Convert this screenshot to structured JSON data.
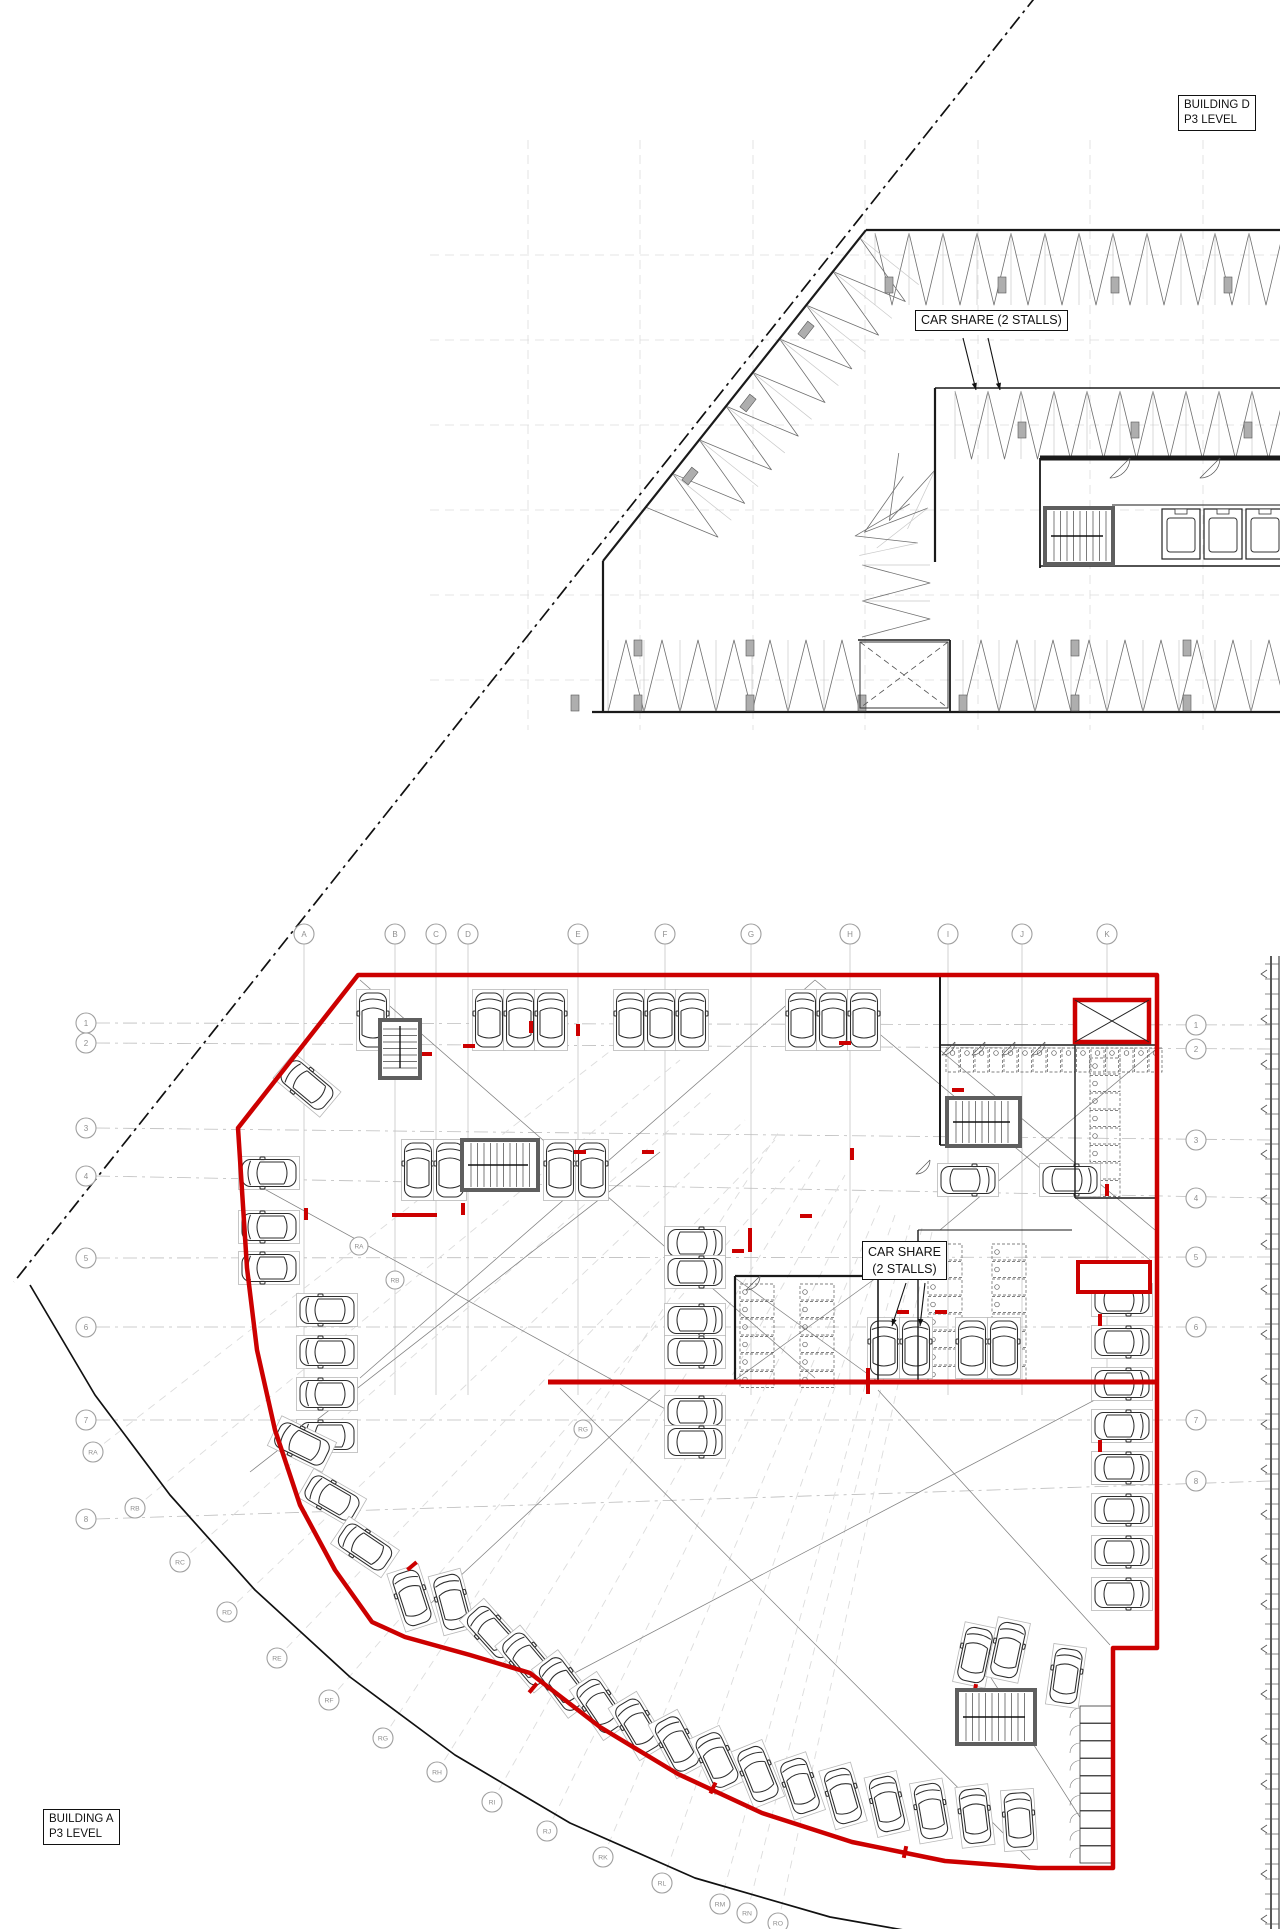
{
  "labels": {
    "building_d": {
      "line1": "BUILDING D",
      "line2": "P3 LEVEL"
    },
    "car_share_top": "CAR SHARE (2 STALLS)",
    "car_share_lower": {
      "line1": "CAR SHARE",
      "line2": "(2 STALLS)"
    },
    "building_a": {
      "line1": "BUILDING A",
      "line2": "P3 LEVEL"
    }
  },
  "colors": {
    "wall_red": "#cc0000",
    "line": "#1c1c1c",
    "core_gray": "#5f5f5f",
    "grid_light": "#dcdcdc",
    "grid_mid": "#bdbdbd",
    "stall_gray": "#b8b8b8",
    "sight": "#808080",
    "column_fill": "#aeaeae",
    "bubble": "#a0a0a0",
    "rack": "#5a5a5a"
  },
  "grid": {
    "letters": [
      {
        "label": "A",
        "x": 304
      },
      {
        "label": "B",
        "x": 395
      },
      {
        "label": "C",
        "x": 436
      },
      {
        "label": "D",
        "x": 468
      },
      {
        "label": "E",
        "x": 578
      },
      {
        "label": "F",
        "x": 665
      },
      {
        "label": "G",
        "x": 751
      },
      {
        "label": "H",
        "x": 850
      },
      {
        "label": "I",
        "x": 948
      },
      {
        "label": "J",
        "x": 1022
      },
      {
        "label": "K",
        "x": 1107
      }
    ],
    "letter_bubble_y": 934,
    "letter_line": [
      944,
      1395
    ],
    "numbers": [
      {
        "label": "1",
        "yl": 1023,
        "yr": 1025
      },
      {
        "label": "2",
        "yl": 1043,
        "yr": 1049
      },
      {
        "label": "3",
        "yl": 1128,
        "yr": 1140
      },
      {
        "label": "4",
        "yl": 1176,
        "yr": 1198
      },
      {
        "label": "5",
        "yl": 1258,
        "yr": 1257
      },
      {
        "label": "6",
        "yl": 1327,
        "yr": 1327
      },
      {
        "label": "7",
        "yl": 1420,
        "yr": 1420
      },
      {
        "label": "8",
        "yl": 1519,
        "yr": 1481
      }
    ],
    "num_x_left": 86,
    "num_x_right": 1196,
    "radial": [
      {
        "label": "RA",
        "x": 93,
        "y": 1452,
        "ix": 640,
        "iy": 1028
      },
      {
        "label": "RB",
        "x": 135,
        "y": 1508,
        "ix": 680,
        "iy": 1060
      },
      {
        "label": "RC",
        "x": 180,
        "y": 1562,
        "ix": 712,
        "iy": 1092
      },
      {
        "label": "RD",
        "x": 227,
        "y": 1612,
        "ix": 745,
        "iy": 1120
      },
      {
        "label": "RE",
        "x": 277,
        "y": 1658,
        "ix": 775,
        "iy": 1140
      },
      {
        "label": "RF",
        "x": 329,
        "y": 1700,
        "ix": 800,
        "iy": 1160
      },
      {
        "label": "RG",
        "x": 383,
        "y": 1738,
        "ix": 780,
        "iy": 1130
      },
      {
        "label": "RH",
        "x": 437,
        "y": 1772,
        "ix": 820,
        "iy": 1160
      },
      {
        "label": "RI",
        "x": 492,
        "y": 1802,
        "ix": 845,
        "iy": 1175
      },
      {
        "label": "RJ",
        "x": 547,
        "y": 1831,
        "ix": 862,
        "iy": 1190
      },
      {
        "label": "RK",
        "x": 603,
        "y": 1857,
        "ix": 880,
        "iy": 1205
      },
      {
        "label": "RL",
        "x": 662,
        "y": 1883,
        "ix": 895,
        "iy": 1215
      },
      {
        "label": "RM",
        "x": 720,
        "y": 1904,
        "ix": 910,
        "iy": 1225
      },
      {
        "label": "RN",
        "x": 747,
        "y": 1913,
        "ix": 922,
        "iy": 1228
      },
      {
        "label": "RO",
        "x": 778,
        "y": 1923,
        "ix": 932,
        "iy": 1232
      }
    ],
    "radial_inner": [
      {
        "label": "RA",
        "x": 359,
        "y": 1246
      },
      {
        "label": "RB",
        "x": 395,
        "y": 1280
      },
      {
        "label": "RG",
        "x": 583,
        "y": 1429
      }
    ]
  },
  "upper_grid": {
    "vx": [
      528,
      640,
      753,
      865,
      978,
      1090,
      1203
    ],
    "vy0": 140,
    "vy1": 730,
    "hy": [
      255,
      340,
      425,
      510,
      595,
      680
    ],
    "hx0": 430,
    "hx1": 1285
  },
  "boundary": {
    "property_line": [
      1037,
      -5,
      14,
      1282
    ],
    "outer_curve": [
      [
        30,
        1285
      ],
      [
        95,
        1395
      ],
      [
        170,
        1495
      ],
      [
        255,
        1590
      ],
      [
        350,
        1677
      ],
      [
        455,
        1755
      ],
      [
        570,
        1823
      ],
      [
        695,
        1878
      ],
      [
        830,
        1917
      ],
      [
        960,
        1940
      ]
    ]
  },
  "upper_plan": {
    "walls": [
      [
        866,
        230,
        1280,
        230,
        2.2
      ],
      [
        866,
        230,
        603,
        561,
        2.2
      ],
      [
        603,
        561,
        603,
        712,
        2.2
      ],
      [
        592,
        712,
        1280,
        712,
        2.2
      ],
      [
        935,
        388,
        1280,
        388,
        1.6
      ],
      [
        935,
        388,
        935,
        562,
        2.2
      ],
      [
        950,
        640,
        950,
        712,
        1.8
      ],
      [
        858,
        640,
        950,
        640,
        1.4
      ],
      [
        1040,
        458,
        1280,
        458,
        5
      ],
      [
        1040,
        458,
        1040,
        568,
        1.8
      ],
      [
        1040,
        566,
        1280,
        566,
        1.6
      ],
      [
        1112,
        505,
        1280,
        505,
        1
      ]
    ],
    "bands": [
      {
        "x": 875,
        "y": 233,
        "ang": 0,
        "n": 12,
        "pitch": 34,
        "depth": 72,
        "s": 1
      },
      {
        "x": 860,
        "y": 238,
        "ang": 128.5,
        "n": 8,
        "pitch": 43,
        "depth": 75,
        "s": -1
      },
      {
        "x": 955,
        "y": 391,
        "ang": 0,
        "n": 10,
        "pitch": 33,
        "depth": 68,
        "s": 1
      },
      {
        "x": 608,
        "y": 712,
        "ang": 0,
        "n": 7,
        "pitch": 36,
        "depth": -72,
        "s": 1
      },
      {
        "x": 963,
        "y": 712,
        "ang": 0,
        "n": 9,
        "pitch": 36,
        "depth": -72,
        "s": 1
      },
      {
        "x": 862,
        "y": 565,
        "ang": 90,
        "n": 2,
        "pitch": 36,
        "depth": 68,
        "s": -1
      },
      {
        "x": 935,
        "y": 470,
        "ang": 205,
        "n": 1,
        "pitch": 40,
        "depth": 65,
        "s": -1
      },
      {
        "x": 928,
        "y": 508,
        "ang": 232,
        "n": 1,
        "pitch": 40,
        "depth": 65,
        "s": -1
      },
      {
        "x": 918,
        "y": 543,
        "ang": 258,
        "n": 1,
        "pitch": 40,
        "depth": 60,
        "s": -1
      }
    ],
    "columns": [
      [
        889,
        285,
        0
      ],
      [
        1002,
        285,
        0
      ],
      [
        1115,
        285,
        0
      ],
      [
        1228,
        285,
        0
      ],
      [
        806,
        330,
        38
      ],
      [
        748,
        403,
        38
      ],
      [
        690,
        476,
        38
      ],
      [
        575,
        703,
        0
      ],
      [
        638,
        703,
        0
      ],
      [
        750,
        703,
        0
      ],
      [
        862,
        703,
        0
      ],
      [
        963,
        703,
        0
      ],
      [
        1075,
        703,
        0
      ],
      [
        1187,
        703,
        0
      ],
      [
        638,
        648,
        0
      ],
      [
        750,
        648,
        0
      ],
      [
        1075,
        648,
        0
      ],
      [
        1187,
        648,
        0
      ],
      [
        1022,
        430,
        0
      ],
      [
        1135,
        430,
        0
      ],
      [
        1248,
        430,
        0
      ]
    ],
    "stair": [
      1045,
      508,
      68,
      56,
      "v"
    ],
    "elevators": {
      "x0": 1162,
      "y": 509,
      "w": 38,
      "h": 50,
      "gap": 4,
      "n": 3
    },
    "shaft_dashed": [
      860,
      642,
      88,
      66
    ],
    "door_arcs": [
      [
        1130,
        458,
        20
      ],
      [
        1220,
        458,
        20
      ]
    ]
  },
  "lower_plan": {
    "perimeter": [
      [
        358,
        975
      ],
      [
        1157,
        975
      ],
      [
        1157,
        1648
      ],
      [
        1113,
        1648
      ],
      [
        1113,
        1868
      ],
      [
        1038,
        1868
      ],
      [
        945,
        1861
      ],
      [
        852,
        1842
      ],
      [
        762,
        1813
      ],
      [
        678,
        1774
      ],
      [
        600,
        1727
      ],
      [
        530,
        1673
      ],
      [
        470,
        1655
      ],
      [
        405,
        1637
      ],
      [
        372,
        1622
      ],
      [
        335,
        1570
      ],
      [
        300,
        1505
      ],
      [
        275,
        1430
      ],
      [
        257,
        1350
      ],
      [
        247,
        1268
      ],
      [
        238,
        1128
      ]
    ],
    "interior_red": [
      [
        548,
        1382,
        1157,
        1382,
        5
      ],
      [
        392,
        1215,
        437,
        1215,
        4
      ],
      [
        750,
        1228,
        750,
        1252,
        4
      ],
      [
        868,
        1368,
        868,
        1394,
        4
      ]
    ],
    "shaft": [
      1075,
      1000,
      74,
      42
    ],
    "shaft2": [
      1078,
      1262,
      72,
      30
    ],
    "walls": [
      [
        940,
        975,
        940,
        1145,
        2
      ],
      [
        940,
        1045,
        1155,
        1045,
        1.6
      ],
      [
        940,
        1145,
        1022,
        1145,
        1.6
      ],
      [
        1075,
        1045,
        1075,
        1198,
        1.4
      ],
      [
        1075,
        1198,
        1155,
        1198,
        1.4
      ],
      [
        735,
        1276,
        878,
        1276,
        2.2
      ],
      [
        735,
        1276,
        735,
        1382,
        2.2
      ],
      [
        878,
        1276,
        878,
        1382,
        1.6
      ],
      [
        918,
        1230,
        918,
        1382,
        1.4
      ],
      [
        918,
        1230,
        1072,
        1230,
        1
      ]
    ],
    "stairs": [
      [
        947,
        1098,
        73,
        48,
        "v"
      ],
      [
        462,
        1140,
        76,
        50,
        "v"
      ],
      [
        380,
        1020,
        40,
        58,
        "h"
      ],
      [
        957,
        1690,
        78,
        54,
        "v"
      ]
    ],
    "rack_zones": [
      {
        "x": 946,
        "y": 1048,
        "cw": 13,
        "ch": 24,
        "nx": 15,
        "ny": 1,
        "dir": "d"
      },
      {
        "x": 1090,
        "y": 1058,
        "cw": 30,
        "ch": 16,
        "nx": 1,
        "ny": 8,
        "dir": "l"
      },
      {
        "x": 740,
        "y": 1284,
        "cw": 34,
        "ch": 16,
        "nx": 1,
        "ny": 6,
        "dir": "l"
      },
      {
        "x": 800,
        "y": 1284,
        "cw": 34,
        "ch": 16,
        "nx": 1,
        "ny": 6,
        "dir": "l"
      },
      {
        "x": 928,
        "y": 1244,
        "cw": 34,
        "ch": 16,
        "nx": 1,
        "ny": 8,
        "dir": "l"
      },
      {
        "x": 992,
        "y": 1244,
        "cw": 34,
        "ch": 16,
        "nx": 1,
        "ny": 8,
        "dir": "l"
      }
    ],
    "lockers": {
      "x": 1080,
      "y": 1706,
      "w": 32,
      "h": 17,
      "n": 9
    },
    "door_arcs": [
      [
        955,
        1042,
        13
      ],
      [
        985,
        1042,
        13
      ],
      [
        1015,
        1042,
        13
      ],
      [
        1045,
        1042,
        13
      ],
      [
        760,
        1276,
        14
      ],
      [
        930,
        1160,
        14
      ]
    ],
    "sight_lines": [
      [
        360,
        980,
        815,
        1378
      ],
      [
        815,
        980,
        360,
        1378
      ],
      [
        815,
        980,
        1150,
        1260
      ],
      [
        940,
        1050,
        1155,
        1230
      ],
      [
        1155,
        1050,
        940,
        1230
      ],
      [
        248,
        1180,
        700,
        1428
      ],
      [
        660,
        1152,
        250,
        1472
      ],
      [
        560,
        1388,
        1030,
        1860
      ],
      [
        1110,
        1392,
        565,
        1678
      ],
      [
        878,
        1390,
        1110,
        1645
      ],
      [
        660,
        1390,
        428,
        1606
      ],
      [
        963,
        1634,
        1106,
        1858
      ],
      [
        735,
        1278,
        876,
        1380
      ],
      [
        876,
        1278,
        735,
        1380
      ]
    ],
    "cars": [
      [
        373,
        1020,
        0
      ],
      [
        489,
        1020,
        0
      ],
      [
        520,
        1020,
        0
      ],
      [
        551,
        1020,
        0
      ],
      [
        630,
        1020,
        0
      ],
      [
        661,
        1020,
        0
      ],
      [
        692,
        1020,
        0
      ],
      [
        802,
        1020,
        0
      ],
      [
        833,
        1020,
        0
      ],
      [
        864,
        1020,
        0
      ],
      [
        418,
        1170,
        0
      ],
      [
        450,
        1170,
        0
      ],
      [
        560,
        1170,
        0
      ],
      [
        592,
        1170,
        0
      ],
      [
        269,
        1173,
        -90
      ],
      [
        269,
        1227,
        -90
      ],
      [
        269,
        1268,
        -90
      ],
      [
        327,
        1310,
        -90
      ],
      [
        327,
        1352,
        -90
      ],
      [
        327,
        1394,
        -90
      ],
      [
        327,
        1436,
        -90
      ],
      [
        695,
        1243,
        90
      ],
      [
        695,
        1272,
        90
      ],
      [
        695,
        1320,
        90
      ],
      [
        695,
        1352,
        90
      ],
      [
        695,
        1412,
        90
      ],
      [
        695,
        1442,
        90
      ],
      [
        884,
        1348,
        0
      ],
      [
        916,
        1348,
        0
      ],
      [
        972,
        1348,
        0
      ],
      [
        1004,
        1348,
        0
      ],
      [
        968,
        1180,
        90
      ],
      [
        1070,
        1180,
        90
      ],
      [
        1122,
        1300,
        90
      ],
      [
        1122,
        1342,
        90
      ],
      [
        1122,
        1384,
        90
      ],
      [
        1122,
        1426,
        90
      ],
      [
        1122,
        1468,
        90
      ],
      [
        1122,
        1510,
        90
      ],
      [
        1122,
        1552,
        90
      ],
      [
        1122,
        1594,
        90
      ],
      [
        307,
        1085,
        -50
      ],
      [
        302,
        1444,
        -64
      ],
      [
        332,
        1498,
        -60
      ],
      [
        365,
        1547,
        -56
      ],
      [
        412,
        1598,
        -18
      ],
      [
        452,
        1602,
        -15
      ],
      [
        492,
        1632,
        -42
      ],
      [
        527,
        1659,
        -40
      ],
      [
        563,
        1684,
        -37
      ],
      [
        600,
        1706,
        -34
      ],
      [
        638,
        1726,
        -31
      ],
      [
        677,
        1744,
        -28
      ],
      [
        717,
        1760,
        -25
      ],
      [
        758,
        1774,
        -22
      ],
      [
        800,
        1786,
        -19
      ],
      [
        843,
        1796,
        -16
      ],
      [
        887,
        1804,
        -13
      ],
      [
        931,
        1811,
        -10
      ],
      [
        975,
        1816,
        -7
      ],
      [
        1019,
        1820,
        -4
      ],
      [
        975,
        1655,
        12
      ],
      [
        1008,
        1650,
        12
      ],
      [
        1066,
        1676,
        8
      ]
    ],
    "red_ticks": [
      [
        394,
        1056,
        90
      ],
      [
        426,
        1054,
        90
      ],
      [
        469,
        1046,
        90
      ],
      [
        531,
        1027,
        0
      ],
      [
        578,
        1030,
        0
      ],
      [
        738,
        1251,
        90
      ],
      [
        806,
        1216,
        90
      ],
      [
        852,
        1154,
        0
      ],
      [
        463,
        1209,
        0
      ],
      [
        306,
        1214,
        0
      ],
      [
        845,
        1043,
        90
      ],
      [
        958,
        1090,
        90
      ],
      [
        580,
        1152,
        90
      ],
      [
        648,
        1152,
        90
      ],
      [
        1107,
        1190,
        0
      ],
      [
        1100,
        1320,
        0
      ],
      [
        1100,
        1446,
        0
      ],
      [
        903,
        1312,
        90
      ],
      [
        941,
        1312,
        90
      ],
      [
        533,
        1688,
        40
      ],
      [
        713,
        1788,
        25
      ],
      [
        905,
        1852,
        12
      ],
      [
        412,
        1566,
        50
      ],
      [
        975,
        1690,
        10
      ]
    ]
  },
  "right_strip": {
    "x1": 1271,
    "x2": 1279,
    "y0": 956,
    "y1": 1929,
    "tick_step": 15,
    "chev_step": 45
  },
  "arrows": [
    [
      963,
      338,
      976,
      390
    ],
    [
      988,
      338,
      1000,
      390
    ],
    [
      906,
      1283,
      892,
      1326
    ],
    [
      925,
      1283,
      920,
      1326
    ]
  ]
}
